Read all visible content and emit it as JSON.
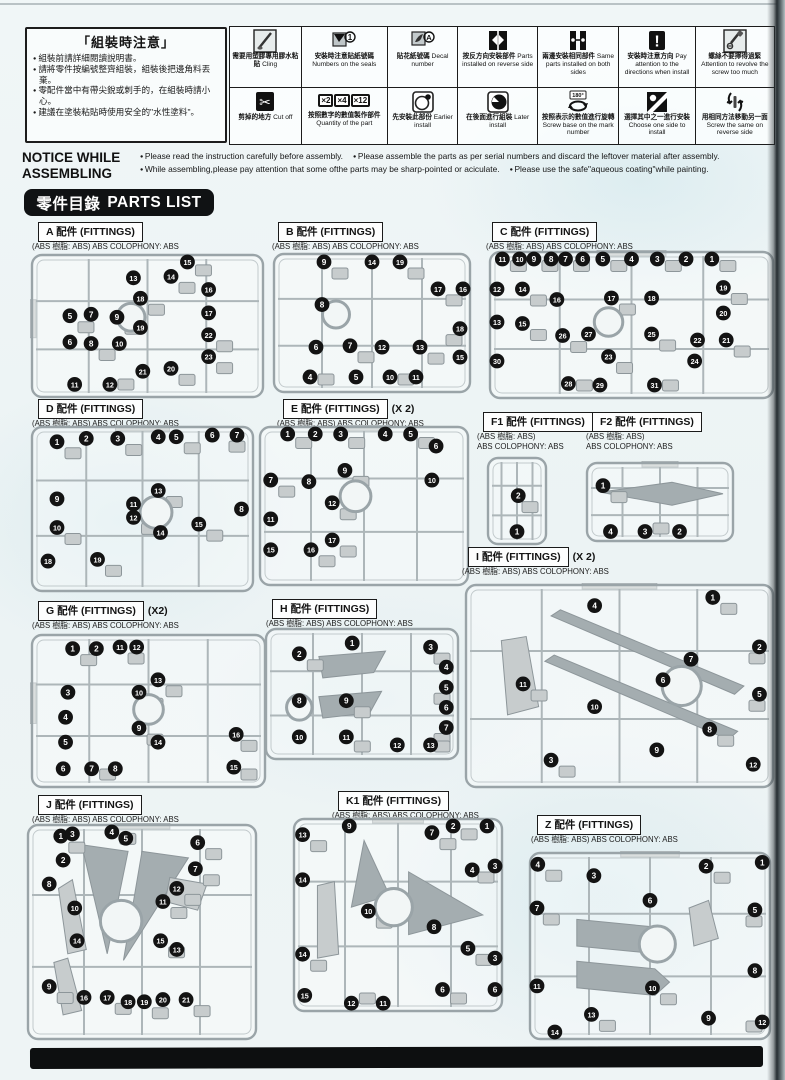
{
  "notice_box": {
    "title": "「組裝時注意」",
    "items": [
      "組裝前請詳細閱讀說明書。",
      "請將零件按編號整齊組裝，組裝後把邊角料丟棄。",
      "零配件當中有帶尖銳或刺手的，在組裝時請小心。",
      "建議在塗裝粘貼時使用安全的\"水性塗料\"。"
    ]
  },
  "icon_table": {
    "quantity_boxes": [
      "×2",
      "×4",
      "×12"
    ],
    "cells": [
      {
        "icon": "glue-brush-icon",
        "zh": "需要用塑膠專用膠水粘貼",
        "en": "Cling"
      },
      {
        "icon": "sticker-number-icon",
        "zh": "安裝時注意貼紙號碼",
        "en": "Numbers on the seals"
      },
      {
        "icon": "decal-brush-icon",
        "zh": "貼花紙號碼",
        "en": "Decal number"
      },
      {
        "icon": "reverse-side-icon",
        "zh": "按反方向安裝部件",
        "en": "Parts installed on reverse side"
      },
      {
        "icon": "both-sides-icon",
        "zh": "兩邊安裝相同部件",
        "en": "Same parts installed on both sides"
      },
      {
        "icon": "direction-warning-icon",
        "zh": "安裝時注意方向",
        "en": "Pay attention to the directions when install"
      },
      {
        "icon": "screw-warning-icon",
        "zh": "螺絲不要擰得過緊",
        "en": "Attention to revolve the screw too much"
      },
      {
        "icon": "cut-off-icon",
        "zh": "剪掉的地方",
        "en": "Cut off"
      },
      {
        "icon": "quantity-icon",
        "zh": "按照數字的數值製作部件",
        "en": "Quantity of the part"
      },
      {
        "icon": "earlier-install-icon",
        "zh": "先安裝此部份",
        "en": "Earlier install"
      },
      {
        "icon": "later-install-icon",
        "zh": "在後面進行組裝",
        "en": "Later install"
      },
      {
        "icon": "screw-base-icon",
        "zh": "按照表示的數值進行旋轉",
        "en": "Screw base on the mark number"
      },
      {
        "icon": "choose-side-icon",
        "zh": "選擇其中之一進行安裝",
        "en": "Choose one side to install"
      },
      {
        "icon": "screw-reverse-icon",
        "zh": "用相同方法移動另一面",
        "en": "Screw the same on reverse side"
      }
    ]
  },
  "notice_while": {
    "title_line1": "NOTICE WHILE",
    "title_line2": "ASSEMBLING",
    "bullets": [
      "Please read the instruction carefully before assembly.",
      "Please assemble the parts as per serial numbers and discard the leftover material after assembly.",
      "While assembling,please pay attention that some ofthe parts may be sharp-pointed or aciculate.",
      "Please use the safe\"aqueous coating\"while painting."
    ]
  },
  "parts_list_badge": {
    "zh": "零件目錄",
    "en": "PARTS LIST"
  },
  "material_standard": "(ABS 樹脂: ABS) ABS COLOPHONY: ABS",
  "sections": [
    {
      "id": "A",
      "label": "A 配件 (FITTINGS)",
      "mult": "",
      "material": [
        "(ABS 樹脂: ABS) ABS COLOPHONY: ABS"
      ],
      "parts": [
        [
          15,
          67,
          4
        ],
        [
          13,
          44,
          17
        ],
        [
          14,
          60,
          16
        ],
        [
          16,
          76,
          25
        ],
        [
          18,
          47,
          31
        ],
        [
          17,
          76,
          41
        ],
        [
          5,
          17,
          43
        ],
        [
          7,
          26,
          42
        ],
        [
          9,
          37,
          44
        ],
        [
          19,
          47,
          51
        ],
        [
          22,
          76,
          56
        ],
        [
          6,
          17,
          61
        ],
        [
          8,
          26,
          62
        ],
        [
          10,
          38,
          62
        ],
        [
          23,
          76,
          71
        ],
        [
          21,
          48,
          81
        ],
        [
          20,
          60,
          79
        ],
        [
          11,
          19,
          90
        ],
        [
          12,
          34,
          90
        ]
      ]
    },
    {
      "id": "B",
      "label": "B 配件 (FITTINGS)",
      "mult": "",
      "material": [
        "(ABS 樹脂: ABS) ABS COLOPHONY: ABS"
      ],
      "parts": [
        [
          9,
          26,
          7
        ],
        [
          14,
          50,
          7
        ],
        [
          19,
          64,
          7
        ],
        [
          17,
          83,
          26
        ],
        [
          16,
          96,
          26
        ],
        [
          8,
          25,
          37
        ],
        [
          18,
          94,
          54
        ],
        [
          6,
          22,
          67
        ],
        [
          7,
          39,
          66
        ],
        [
          12,
          55,
          67
        ],
        [
          13,
          74,
          67
        ],
        [
          15,
          94,
          74
        ],
        [
          4,
          19,
          88
        ],
        [
          5,
          42,
          88
        ],
        [
          10,
          59,
          88
        ],
        [
          11,
          72,
          88
        ]
      ]
    },
    {
      "id": "C",
      "label": "C 配件 (FITTINGS)",
      "mult": "",
      "material": [
        "(ABS 樹脂: ABS) ABS COLOPHONY: ABS"
      ],
      "parts": [
        [
          11,
          5,
          3
        ],
        [
          10,
          11,
          3
        ],
        [
          9,
          16,
          3
        ],
        [
          8,
          22,
          3
        ],
        [
          7,
          27,
          3
        ],
        [
          6,
          33,
          3
        ],
        [
          5,
          40,
          3
        ],
        [
          4,
          50,
          3
        ],
        [
          3,
          59,
          3
        ],
        [
          2,
          69,
          3
        ],
        [
          1,
          78,
          3
        ],
        [
          12,
          3,
          26
        ],
        [
          14,
          12,
          26
        ],
        [
          16,
          24,
          33
        ],
        [
          17,
          43,
          32
        ],
        [
          18,
          57,
          32
        ],
        [
          19,
          82,
          25
        ],
        [
          13,
          3,
          48
        ],
        [
          15,
          12,
          49
        ],
        [
          20,
          82,
          42
        ],
        [
          26,
          26,
          57
        ],
        [
          27,
          35,
          56
        ],
        [
          25,
          57,
          56
        ],
        [
          22,
          73,
          60
        ],
        [
          21,
          83,
          60
        ],
        [
          30,
          3,
          74
        ],
        [
          23,
          42,
          71
        ],
        [
          24,
          72,
          74
        ],
        [
          28,
          28,
          89
        ],
        [
          29,
          39,
          90
        ],
        [
          31,
          58,
          90
        ]
      ]
    },
    {
      "id": "D",
      "label": "D 配件 (FITTINGS)",
      "mult": "",
      "material": [
        "(ABS 樹脂: ABS) ABS COLOPHONY: ABS"
      ],
      "parts": [
        [
          1,
          12,
          10
        ],
        [
          2,
          25,
          8
        ],
        [
          3,
          39,
          8
        ],
        [
          4,
          57,
          7
        ],
        [
          5,
          65,
          7
        ],
        [
          6,
          81,
          6
        ],
        [
          7,
          92,
          6
        ],
        [
          9,
          12,
          44
        ],
        [
          13,
          57,
          39
        ],
        [
          11,
          46,
          47
        ],
        [
          12,
          46,
          55
        ],
        [
          8,
          94,
          50
        ],
        [
          10,
          12,
          61
        ],
        [
          14,
          58,
          64
        ],
        [
          15,
          75,
          59
        ],
        [
          18,
          8,
          81
        ],
        [
          19,
          30,
          80
        ]
      ]
    },
    {
      "id": "E",
      "label": "E 配件 (FITTINGS)",
      "mult": "(X 2)",
      "material": [
        "(ABS 樹脂: ABS) ABS COLOPHONY: ABS"
      ],
      "parts": [
        [
          1,
          14,
          4
        ],
        [
          2,
          27,
          4
        ],
        [
          3,
          39,
          4
        ],
        [
          4,
          60,
          4
        ],
        [
          5,
          72,
          4
        ],
        [
          6,
          84,
          13
        ],
        [
          7,
          6,
          34
        ],
        [
          8,
          24,
          35
        ],
        [
          9,
          41,
          28
        ],
        [
          10,
          82,
          34
        ],
        [
          12,
          35,
          48
        ],
        [
          11,
          6,
          58
        ],
        [
          17,
          35,
          71
        ],
        [
          15,
          6,
          77
        ],
        [
          16,
          25,
          77
        ]
      ]
    },
    {
      "id": "F1",
      "label": "F1 配件 (FITTINGS)",
      "mult": "",
      "material": [
        "(ABS 樹脂: ABS)",
        "ABS COLOPHONY: ABS"
      ],
      "parts": [
        [
          2,
          52,
          44
        ],
        [
          1,
          50,
          84
        ]
      ]
    },
    {
      "id": "F2",
      "label": "F2 配件 (FITTINGS)",
      "mult": "",
      "material": [
        "(ABS 樹脂: ABS)",
        "ABS COLOPHONY: ABS"
      ],
      "parts": [
        [
          1,
          12,
          30
        ],
        [
          4,
          17,
          86
        ],
        [
          3,
          40,
          86
        ],
        [
          2,
          63,
          86
        ]
      ]
    },
    {
      "id": "G",
      "label": "G 配件 (FITTINGS)",
      "mult": "(X2)",
      "material": [
        "(ABS 樹脂: ABS) ABS COLOPHONY: ABS"
      ],
      "parts": [
        [
          1,
          18,
          10
        ],
        [
          2,
          28,
          10
        ],
        [
          11,
          38,
          9
        ],
        [
          12,
          45,
          9
        ],
        [
          13,
          54,
          30
        ],
        [
          3,
          16,
          38
        ],
        [
          10,
          46,
          38
        ],
        [
          4,
          15,
          54
        ],
        [
          9,
          46,
          61
        ],
        [
          14,
          54,
          70
        ],
        [
          16,
          87,
          65
        ],
        [
          5,
          15,
          70
        ],
        [
          15,
          86,
          86
        ],
        [
          6,
          14,
          87
        ],
        [
          7,
          26,
          87
        ],
        [
          8,
          36,
          87
        ]
      ]
    },
    {
      "id": "H",
      "label": "H 配件 (FITTINGS)",
      "mult": "",
      "material": [
        "(ABS 樹脂: ABS) ABS COLOPHONY: ABS"
      ],
      "parts": [
        [
          2,
          18,
          20
        ],
        [
          1,
          45,
          12
        ],
        [
          3,
          85,
          15
        ],
        [
          4,
          93,
          30
        ],
        [
          5,
          93,
          45
        ],
        [
          8,
          18,
          55
        ],
        [
          9,
          42,
          55
        ],
        [
          6,
          93,
          60
        ],
        [
          7,
          93,
          75
        ],
        [
          10,
          18,
          82
        ],
        [
          11,
          42,
          82
        ],
        [
          12,
          68,
          88
        ],
        [
          13,
          85,
          88
        ]
      ]
    },
    {
      "id": "I",
      "label": "I 配件 (FITTINGS)",
      "mult": "(X 2)",
      "material": [
        "(ABS 樹脂: ABS) ABS COLOPHONY: ABS"
      ],
      "parts": [
        [
          1,
          80,
          7
        ],
        [
          4,
          42,
          11
        ],
        [
          2,
          95,
          31
        ],
        [
          7,
          73,
          37
        ],
        [
          11,
          19,
          49
        ],
        [
          6,
          64,
          47
        ],
        [
          5,
          95,
          54
        ],
        [
          10,
          42,
          60
        ],
        [
          8,
          79,
          71
        ],
        [
          9,
          62,
          81
        ],
        [
          3,
          28,
          86
        ],
        [
          12,
          93,
          88
        ]
      ]
    },
    {
      "id": "J",
      "label": "J 配件 (FITTINGS)",
      "mult": "",
      "material": [
        "(ABS 樹脂: ABS) ABS COLOPHONY: ABS"
      ],
      "parts": [
        [
          1,
          15,
          6
        ],
        [
          3,
          20,
          5
        ],
        [
          4,
          37,
          2
        ],
        [
          5,
          43,
          7
        ],
        [
          6,
          74,
          9
        ],
        [
          2,
          16,
          17
        ],
        [
          7,
          73,
          21
        ],
        [
          8,
          10,
          28
        ],
        [
          12,
          65,
          30
        ],
        [
          10,
          21,
          39
        ],
        [
          11,
          59,
          36
        ],
        [
          14,
          22,
          54
        ],
        [
          15,
          58,
          54
        ],
        [
          13,
          65,
          58
        ],
        [
          9,
          10,
          75
        ],
        [
          16,
          25,
          80
        ],
        [
          17,
          35,
          80
        ],
        [
          18,
          44,
          82
        ],
        [
          19,
          51,
          82
        ],
        [
          20,
          59,
          81
        ],
        [
          21,
          69,
          81
        ]
      ]
    },
    {
      "id": "K1",
      "label": "K1 配件 (FITTINGS)",
      "mult": "",
      "material": [
        "(ABS 樹脂: ABS) ABS COLOPHONY: ABS"
      ],
      "parts": [
        [
          13,
          5,
          9
        ],
        [
          9,
          27,
          3
        ],
        [
          2,
          76,
          3
        ],
        [
          1,
          92,
          4
        ],
        [
          7,
          66,
          8
        ],
        [
          4,
          85,
          27
        ],
        [
          3,
          97,
          25
        ],
        [
          14,
          5,
          32
        ],
        [
          10,
          36,
          48
        ],
        [
          8,
          67,
          56
        ],
        [
          5,
          83,
          67
        ],
        [
          3,
          97,
          72
        ],
        [
          14,
          5,
          70
        ],
        [
          15,
          6,
          91
        ],
        [
          12,
          28,
          95
        ],
        [
          11,
          43,
          95
        ],
        [
          6,
          71,
          88
        ],
        [
          6,
          96,
          88
        ]
      ]
    },
    {
      "id": "Z",
      "label": "Z 配件 (FITTINGS)",
      "mult": "",
      "material": [
        "(ABS 樹脂: ABS) ABS COLOPHONY: ABS"
      ],
      "parts": [
        [
          4,
          4,
          7
        ],
        [
          3,
          27,
          13
        ],
        [
          2,
          73,
          8
        ],
        [
          1,
          96,
          6
        ],
        [
          7,
          3,
          30
        ],
        [
          6,
          50,
          26
        ],
        [
          5,
          93,
          31
        ],
        [
          11,
          3,
          71
        ],
        [
          10,
          51,
          72
        ],
        [
          8,
          93,
          63
        ],
        [
          13,
          26,
          86
        ],
        [
          9,
          74,
          88
        ],
        [
          12,
          96,
          90
        ],
        [
          14,
          11,
          96
        ]
      ]
    }
  ]
}
